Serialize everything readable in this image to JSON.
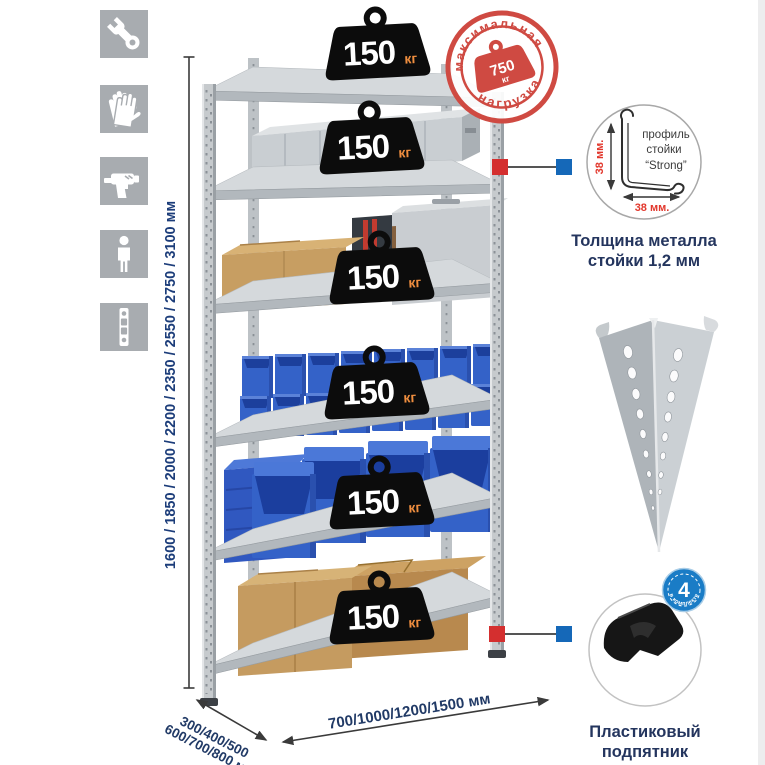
{
  "page": {
    "background": "#ffffff"
  },
  "sidebar": {
    "tile_color": "#a8acb0",
    "icons": [
      "wrench",
      "work-gloves",
      "drill",
      "person-height",
      "perforated-upright"
    ]
  },
  "shelf_badge": {
    "value": "150",
    "unit": "кг"
  },
  "stamp": {
    "arc_top": "максимальная",
    "arc_bottom": "нагрузка",
    "weight_value": "750",
    "weight_unit": "кг",
    "color": "#cf4a42"
  },
  "dimensions": {
    "height_options": "1600 / 1850 / 2000 / 2200 / 2350 / 2550 / 2750 / 3100 мм",
    "depth_options_line1": "300/400/500",
    "depth_options_line2": "600/700/800 мм",
    "width_options": "700/1000/1200/1500 мм",
    "text_color": "#1c3d7a"
  },
  "profile_callout": {
    "label_line1": "профиль",
    "label_line2": "стойки",
    "label_line3": "“Strong”",
    "dim_vertical": "38 мм.",
    "dim_horizontal": "38 мм.",
    "caption_line1": "Толщина металла",
    "caption_line2": "стойки 1,2 мм"
  },
  "foot_callout": {
    "badge_value": "4",
    "badge_arc": "в комплекте",
    "caption_line1": "Пластиковый",
    "caption_line2": "подпятник"
  },
  "colors": {
    "accent_red": "#d42f2f",
    "accent_blue": "#1568b8",
    "navy": "#24355e",
    "bin_blue": "#3462c8",
    "cardboard": "#c59b60",
    "metal_light": "#d5d9dc",
    "metal_mid": "#c6cacd"
  }
}
